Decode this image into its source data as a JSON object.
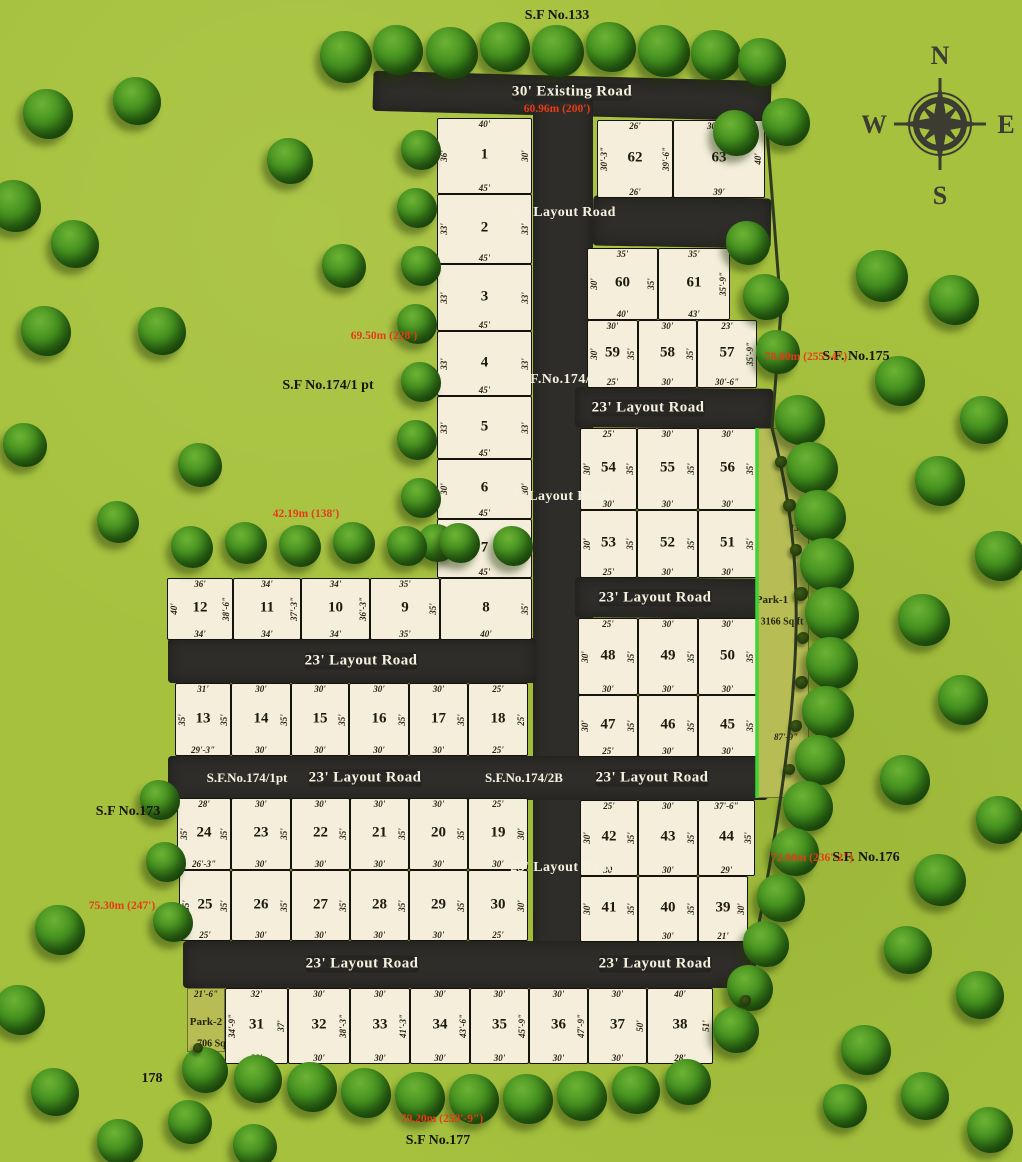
{
  "colors": {
    "background": "#a6c13e",
    "road": "#2e2d29",
    "plot_fill": "#f4eedb",
    "plot_border": "#15130e",
    "park_fill": "#b7bc55",
    "red_text": "#e63b17",
    "road_text": "#f6f1df",
    "label_text": "#15150c",
    "park_edge_green": "#3fd334",
    "boundary_line": "#2f3a22"
  },
  "compass": {
    "n": "N",
    "e": "E",
    "s": "S",
    "w": "W"
  },
  "roads": [
    {
      "name": "existing-road",
      "x": 373,
      "y": 76,
      "w": 398,
      "h": 40,
      "rot": 1.5
    },
    {
      "name": "vertical-layout-road",
      "x": 533,
      "y": 96,
      "w": 60,
      "h": 892,
      "rot": 0
    },
    {
      "name": "connector-road",
      "x": 593,
      "y": 197,
      "w": 178,
      "h": 50,
      "rot": 1
    },
    {
      "name": "layout-road-right-1",
      "x": 575,
      "y": 388,
      "w": 198,
      "h": 40,
      "rot": 0.5
    },
    {
      "name": "layout-road-right-2",
      "x": 575,
      "y": 578,
      "w": 193,
      "h": 40,
      "rot": 0.5
    },
    {
      "name": "layout-road-left-1",
      "x": 168,
      "y": 638,
      "w": 368,
      "h": 45,
      "rot": 0
    },
    {
      "name": "layout-road-middle",
      "x": 168,
      "y": 756,
      "w": 600,
      "h": 44,
      "rot": 0
    },
    {
      "name": "layout-road-bottom",
      "x": 183,
      "y": 941,
      "w": 573,
      "h": 47,
      "rot": 0
    }
  ],
  "labels": [
    {
      "text": "30' Existing Road",
      "x": 572,
      "y": 92,
      "rot": 1.5,
      "cls": "road"
    },
    {
      "text": "60.96m (200')",
      "x": 557,
      "y": 109,
      "rot": 1.5,
      "cls": "red"
    },
    {
      "text": "25' Layout Road",
      "x": 563,
      "y": 213,
      "rot": -90,
      "cls": "roadv"
    },
    {
      "text": "S.F.No.174/2A",
      "x": 563,
      "y": 380,
      "rot": -90,
      "cls": "roadv"
    },
    {
      "text": "25' Layout Road",
      "x": 558,
      "y": 497,
      "rot": -90,
      "cls": "roadv"
    },
    {
      "text": "25' Layout Road",
      "x": 563,
      "y": 868,
      "rot": -90,
      "cls": "roadv"
    },
    {
      "text": "23' Layout Road",
      "x": 648,
      "y": 408,
      "rot": 0,
      "cls": "road"
    },
    {
      "text": "23' Layout Road",
      "x": 655,
      "y": 598,
      "rot": 0,
      "cls": "road"
    },
    {
      "text": "23' Layout Road",
      "x": 361,
      "y": 661,
      "rot": 0,
      "cls": "road"
    },
    {
      "text": "S.F.No.174/1pt",
      "x": 247,
      "y": 778,
      "rot": 0,
      "cls": "roadsf"
    },
    {
      "text": "23' Layout Road",
      "x": 365,
      "y": 778,
      "rot": 0,
      "cls": "road"
    },
    {
      "text": "S.F.No.174/2B",
      "x": 524,
      "y": 778,
      "rot": 0,
      "cls": "roadsf"
    },
    {
      "text": "23' Layout Road",
      "x": 652,
      "y": 778,
      "rot": 0,
      "cls": "road"
    },
    {
      "text": "23' Layout Road",
      "x": 362,
      "y": 964,
      "rot": 0,
      "cls": "road"
    },
    {
      "text": "23' Layout Road",
      "x": 655,
      "y": 964,
      "rot": 0,
      "cls": "road"
    },
    {
      "text": "S.F No.133",
      "x": 557,
      "y": 16,
      "rot": 0,
      "cls": "sf"
    },
    {
      "text": "S.F No.174/1 pt",
      "x": 328,
      "y": 386,
      "rot": 0,
      "cls": "sf"
    },
    {
      "text": "S.F. No.175",
      "x": 856,
      "y": 357,
      "rot": 0,
      "cls": "sf"
    },
    {
      "text": "S.F No.173",
      "x": 128,
      "y": 812,
      "rot": -68,
      "cls": "sf"
    },
    {
      "text": "S.F. No.176",
      "x": 866,
      "y": 858,
      "rot": 0,
      "cls": "sf"
    },
    {
      "text": "S.F No.177",
      "x": 438,
      "y": 1141,
      "rot": 0,
      "cls": "sf"
    },
    {
      "text": "178",
      "x": 152,
      "y": 1079,
      "rot": 0,
      "cls": "sf"
    },
    {
      "text": "69.50m (228')",
      "x": 384,
      "y": 336,
      "rot": -90,
      "cls": "red"
    },
    {
      "text": "42.19m (138')",
      "x": 306,
      "y": 514,
      "rot": 0,
      "cls": "red"
    },
    {
      "text": "75.30m (247')",
      "x": 122,
      "y": 906,
      "rot": -72,
      "cls": "red"
    },
    {
      "text": "78.00m (255'-4\")",
      "x": 806,
      "y": 357,
      "rot": 62,
      "cls": "red"
    },
    {
      "text": "72.00m (236'-2\")",
      "x": 812,
      "y": 858,
      "rot": 72,
      "cls": "red"
    },
    {
      "text": "79.20m (259'-9\")",
      "x": 442,
      "y": 1119,
      "rot": 0,
      "cls": "red"
    }
  ],
  "plots": [
    {
      "no": "1",
      "x": 437,
      "y": 118,
      "w": 95,
      "h": 76,
      "t": "40'",
      "l": "36'",
      "r": "30'",
      "b": "45'"
    },
    {
      "no": "2",
      "x": 437,
      "y": 194,
      "w": 95,
      "h": 70,
      "l": "33'",
      "r": "33'",
      "b": "45'"
    },
    {
      "no": "3",
      "x": 437,
      "y": 264,
      "w": 95,
      "h": 67,
      "l": "33'",
      "r": "33'",
      "b": "45'"
    },
    {
      "no": "4",
      "x": 437,
      "y": 331,
      "w": 95,
      "h": 65,
      "l": "33'",
      "r": "33'",
      "b": "45'"
    },
    {
      "no": "5",
      "x": 437,
      "y": 396,
      "w": 95,
      "h": 63,
      "l": "33'",
      "r": "33'",
      "b": "45'"
    },
    {
      "no": "6",
      "x": 437,
      "y": 459,
      "w": 95,
      "h": 60,
      "l": "30'",
      "r": "30'",
      "b": "45'"
    },
    {
      "no": "7",
      "x": 437,
      "y": 519,
      "w": 95,
      "h": 59,
      "l": "30'",
      "r": "30'",
      "b": "45'"
    },
    {
      "no": "8",
      "x": 440,
      "y": 578,
      "w": 92,
      "h": 62,
      "r": "35'",
      "b": "40'"
    },
    {
      "no": "9",
      "x": 370,
      "y": 578,
      "w": 70,
      "h": 62,
      "t": "35'",
      "r": "35'",
      "b": "35'"
    },
    {
      "no": "10",
      "x": 301,
      "y": 578,
      "w": 69,
      "h": 62,
      "t": "34'",
      "r": "36'-3\"",
      "b": "34'"
    },
    {
      "no": "11",
      "x": 233,
      "y": 578,
      "w": 68,
      "h": 62,
      "t": "34'",
      "r": "37'-3\"",
      "b": "34'"
    },
    {
      "no": "12",
      "x": 167,
      "y": 578,
      "w": 66,
      "h": 62,
      "t": "36'",
      "l": "40'",
      "r": "38'-6\"",
      "b": "34'"
    },
    {
      "no": "13",
      "x": 175,
      "y": 683,
      "w": 56,
      "h": 73,
      "t": "31'",
      "l": "35'",
      "r": "35'",
      "b": "29'-3\""
    },
    {
      "no": "14",
      "x": 231,
      "y": 683,
      "w": 60,
      "h": 73,
      "t": "30'",
      "r": "35'",
      "b": "30'"
    },
    {
      "no": "15",
      "x": 291,
      "y": 683,
      "w": 58,
      "h": 73,
      "t": "30'",
      "r": "35'",
      "b": "30'"
    },
    {
      "no": "16",
      "x": 349,
      "y": 683,
      "w": 60,
      "h": 73,
      "t": "30'",
      "r": "35'",
      "b": "30'"
    },
    {
      "no": "17",
      "x": 409,
      "y": 683,
      "w": 59,
      "h": 73,
      "t": "30'",
      "r": "35'",
      "b": "30'"
    },
    {
      "no": "18",
      "x": 468,
      "y": 683,
      "w": 60,
      "h": 73,
      "t": "25'",
      "r": "25'",
      "b": "25'"
    },
    {
      "no": "19",
      "x": 468,
      "y": 798,
      "w": 60,
      "h": 72,
      "t": "25'",
      "r": "30'",
      "b": "30'"
    },
    {
      "no": "20",
      "x": 409,
      "y": 798,
      "w": 59,
      "h": 72,
      "t": "30'",
      "r": "35'",
      "b": "30'"
    },
    {
      "no": "21",
      "x": 350,
      "y": 798,
      "w": 59,
      "h": 72,
      "t": "30'",
      "r": "35'",
      "b": "30'"
    },
    {
      "no": "22",
      "x": 291,
      "y": 798,
      "w": 59,
      "h": 72,
      "t": "30'",
      "r": "35'",
      "b": "30'"
    },
    {
      "no": "23",
      "x": 231,
      "y": 798,
      "w": 60,
      "h": 72,
      "t": "30'",
      "r": "35'",
      "b": "30'"
    },
    {
      "no": "24",
      "x": 177,
      "y": 798,
      "w": 54,
      "h": 72,
      "t": "28'",
      "l": "35'",
      "r": "35'",
      "b": "26'-3\""
    },
    {
      "no": "25",
      "x": 179,
      "y": 870,
      "w": 52,
      "h": 71,
      "l": "35'",
      "r": "35'",
      "b": "25'"
    },
    {
      "no": "26",
      "x": 231,
      "y": 870,
      "w": 60,
      "h": 71,
      "r": "35'",
      "b": "30'"
    },
    {
      "no": "27",
      "x": 291,
      "y": 870,
      "w": 59,
      "h": 71,
      "r": "35'",
      "b": "30'"
    },
    {
      "no": "28",
      "x": 350,
      "y": 870,
      "w": 59,
      "h": 71,
      "r": "35'",
      "b": "30'"
    },
    {
      "no": "29",
      "x": 409,
      "y": 870,
      "w": 59,
      "h": 71,
      "r": "35'",
      "b": "30'"
    },
    {
      "no": "30",
      "x": 468,
      "y": 870,
      "w": 60,
      "h": 71,
      "r": "30'",
      "b": "25'"
    },
    {
      "no": "31",
      "x": 225,
      "y": 988,
      "w": 63,
      "h": 76,
      "t": "32'",
      "l": "34'-9\"",
      "r": "37'",
      "b": "32'"
    },
    {
      "no": "32",
      "x": 288,
      "y": 988,
      "w": 62,
      "h": 76,
      "t": "30'",
      "r": "38'-3\"",
      "b": "30'"
    },
    {
      "no": "33",
      "x": 350,
      "y": 988,
      "w": 60,
      "h": 76,
      "t": "30'",
      "r": "41'-3\"",
      "b": "30'"
    },
    {
      "no": "34",
      "x": 410,
      "y": 988,
      "w": 60,
      "h": 76,
      "t": "30'",
      "r": "43'-6\"",
      "b": "30'"
    },
    {
      "no": "35",
      "x": 470,
      "y": 988,
      "w": 59,
      "h": 76,
      "t": "30'",
      "r": "45'-9\"",
      "b": "30'"
    },
    {
      "no": "36",
      "x": 529,
      "y": 988,
      "w": 59,
      "h": 76,
      "t": "30'",
      "r": "47'-9\"",
      "b": "30'"
    },
    {
      "no": "37",
      "x": 588,
      "y": 988,
      "w": 59,
      "h": 76,
      "t": "30'",
      "r": "50'",
      "b": "30'"
    },
    {
      "no": "38",
      "x": 647,
      "y": 988,
      "w": 66,
      "h": 76,
      "t": "40'",
      "r": "51'",
      "b": "28'"
    },
    {
      "no": "39",
      "x": 698,
      "y": 876,
      "w": 50,
      "h": 66,
      "r": "30'",
      "b": "21'"
    },
    {
      "no": "40",
      "x": 638,
      "y": 876,
      "w": 60,
      "h": 66,
      "r": "35'",
      "b": "30'"
    },
    {
      "no": "41",
      "x": 580,
      "y": 876,
      "w": 58,
      "h": 66,
      "l": "30'",
      "r": "35'"
    },
    {
      "no": "42",
      "x": 580,
      "y": 800,
      "w": 58,
      "h": 76,
      "t": "25'",
      "l": "30'",
      "r": "35'",
      "b": "30'"
    },
    {
      "no": "43",
      "x": 638,
      "y": 800,
      "w": 60,
      "h": 76,
      "t": "30'",
      "r": "35'",
      "b": "30'"
    },
    {
      "no": "44",
      "x": 698,
      "y": 800,
      "w": 57,
      "h": 76,
      "t": "37'-6\"",
      "r": "35'",
      "b": "29'"
    },
    {
      "no": "45",
      "x": 698,
      "y": 695,
      "w": 59,
      "h": 62,
      "r": "35'",
      "b": "30'"
    },
    {
      "no": "46",
      "x": 638,
      "y": 695,
      "w": 60,
      "h": 62,
      "r": "35'",
      "b": "30'"
    },
    {
      "no": "47",
      "x": 578,
      "y": 695,
      "w": 60,
      "h": 62,
      "l": "30'",
      "r": "35'",
      "b": "25'"
    },
    {
      "no": "48",
      "x": 578,
      "y": 618,
      "w": 60,
      "h": 77,
      "t": "25'",
      "l": "30'",
      "r": "35'",
      "b": "30'"
    },
    {
      "no": "49",
      "x": 638,
      "y": 618,
      "w": 60,
      "h": 77,
      "t": "30'",
      "r": "35'",
      "b": "30'"
    },
    {
      "no": "50",
      "x": 698,
      "y": 618,
      "w": 59,
      "h": 77,
      "t": "30'",
      "r": "35'",
      "b": "30'"
    },
    {
      "no": "51",
      "x": 698,
      "y": 510,
      "w": 59,
      "h": 68,
      "r": "35'",
      "b": "30'"
    },
    {
      "no": "52",
      "x": 637,
      "y": 510,
      "w": 61,
      "h": 68,
      "r": "35'",
      "b": "30'"
    },
    {
      "no": "53",
      "x": 580,
      "y": 510,
      "w": 57,
      "h": 68,
      "l": "30'",
      "r": "35'",
      "b": "25'"
    },
    {
      "no": "54",
      "x": 580,
      "y": 428,
      "w": 57,
      "h": 82,
      "t": "25'",
      "l": "30'",
      "r": "35'",
      "b": "30'"
    },
    {
      "no": "55",
      "x": 637,
      "y": 428,
      "w": 61,
      "h": 82,
      "t": "30'",
      "r": "35'",
      "b": "30'"
    },
    {
      "no": "56",
      "x": 698,
      "y": 428,
      "w": 59,
      "h": 82,
      "t": "30'",
      "r": "35'",
      "b": "30'"
    },
    {
      "no": "57",
      "x": 697,
      "y": 320,
      "w": 60,
      "h": 68,
      "t": "23'",
      "r": "35'-9\"",
      "b": "30'-6\""
    },
    {
      "no": "58",
      "x": 638,
      "y": 320,
      "w": 59,
      "h": 68,
      "t": "30'",
      "r": "35'",
      "b": "30'"
    },
    {
      "no": "59",
      "x": 587,
      "y": 320,
      "w": 51,
      "h": 68,
      "t": "30'",
      "l": "30'",
      "r": "35'",
      "b": "25'"
    },
    {
      "no": "60",
      "x": 587,
      "y": 248,
      "w": 71,
      "h": 72,
      "t": "35'",
      "l": "30'",
      "r": "35'",
      "b": "40'"
    },
    {
      "no": "61",
      "x": 658,
      "y": 248,
      "w": 72,
      "h": 72,
      "t": "35'",
      "r": "35'-9\"",
      "b": "43'"
    },
    {
      "no": "62",
      "x": 597,
      "y": 120,
      "w": 76,
      "h": 78,
      "t": "26'",
      "l": "30'-3\"",
      "r": "39'-6\"",
      "b": "26'"
    },
    {
      "no": "63",
      "x": 673,
      "y": 120,
      "w": 92,
      "h": 78,
      "t": "30'-6\"",
      "r": "40'",
      "b": "39'"
    }
  ],
  "parks": [
    {
      "name": "Park-1",
      "area": "3166 Sq.ft",
      "x": 757,
      "y": 428,
      "w": 52,
      "h": 370,
      "label_x": 772,
      "label_y": 600,
      "label_rot": -52,
      "dims": [
        {
          "text": "131'",
          "x": 798,
          "y": 528,
          "rot": -62
        },
        {
          "text": "87'-9\"",
          "x": 786,
          "y": 737,
          "rot": -70
        }
      ]
    },
    {
      "name": "Park-2",
      "area": "706 Sq.ft",
      "x": 187,
      "y": 988,
      "w": 38,
      "h": 64,
      "label_x": 206,
      "label_y": 1022,
      "label_rot": -58,
      "dims": [
        {
          "text": "21'-6\"",
          "x": 206,
          "y": 994,
          "rot": -6
        },
        {
          "text": "20'",
          "x": 204,
          "y": 1058,
          "rot": -6
        }
      ]
    }
  ],
  "trees": [
    [
      346,
      57,
      52
    ],
    [
      398,
      50,
      50
    ],
    [
      452,
      53,
      52
    ],
    [
      505,
      47,
      50
    ],
    [
      558,
      51,
      52
    ],
    [
      611,
      47,
      50
    ],
    [
      664,
      51,
      52
    ],
    [
      716,
      55,
      50
    ],
    [
      762,
      62,
      48
    ],
    [
      736,
      133,
      46
    ],
    [
      786,
      122,
      48
    ],
    [
      748,
      243,
      44
    ],
    [
      766,
      297,
      46
    ],
    [
      778,
      352,
      44
    ],
    [
      800,
      420,
      50
    ],
    [
      812,
      468,
      52
    ],
    [
      820,
      516,
      52
    ],
    [
      827,
      565,
      54
    ],
    [
      832,
      614,
      54
    ],
    [
      832,
      663,
      52
    ],
    [
      828,
      712,
      52
    ],
    [
      820,
      760,
      50
    ],
    [
      808,
      806,
      50
    ],
    [
      795,
      852,
      48
    ],
    [
      781,
      898,
      48
    ],
    [
      766,
      944,
      46
    ],
    [
      750,
      988,
      46
    ],
    [
      736,
      1030,
      46
    ],
    [
      205,
      1070,
      46
    ],
    [
      258,
      1079,
      48
    ],
    [
      312,
      1087,
      50
    ],
    [
      366,
      1093,
      50
    ],
    [
      420,
      1097,
      50
    ],
    [
      474,
      1099,
      50
    ],
    [
      528,
      1099,
      50
    ],
    [
      582,
      1096,
      50
    ],
    [
      636,
      1090,
      48
    ],
    [
      688,
      1082,
      46
    ],
    [
      421,
      150,
      40
    ],
    [
      417,
      208,
      40
    ],
    [
      421,
      266,
      40
    ],
    [
      417,
      324,
      40
    ],
    [
      421,
      382,
      40
    ],
    [
      417,
      440,
      40
    ],
    [
      421,
      498,
      40
    ],
    [
      437,
      543,
      38
    ],
    [
      192,
      547,
      42
    ],
    [
      246,
      543,
      42
    ],
    [
      300,
      546,
      42
    ],
    [
      354,
      543,
      42
    ],
    [
      407,
      546,
      40
    ],
    [
      460,
      543,
      40
    ],
    [
      513,
      546,
      40
    ],
    [
      160,
      800,
      40
    ],
    [
      166,
      862,
      40
    ],
    [
      173,
      922,
      40
    ],
    [
      48,
      114,
      50
    ],
    [
      137,
      101,
      48
    ],
    [
      15,
      206,
      52
    ],
    [
      290,
      161,
      46
    ],
    [
      75,
      244,
      48
    ],
    [
      344,
      266,
      44
    ],
    [
      162,
      331,
      48
    ],
    [
      46,
      331,
      50
    ],
    [
      25,
      445,
      44
    ],
    [
      200,
      465,
      44
    ],
    [
      118,
      522,
      42
    ],
    [
      882,
      276,
      52
    ],
    [
      954,
      300,
      50
    ],
    [
      900,
      381,
      50
    ],
    [
      984,
      420,
      48
    ],
    [
      940,
      481,
      50
    ],
    [
      1000,
      556,
      50
    ],
    [
      924,
      620,
      52
    ],
    [
      963,
      700,
      50
    ],
    [
      905,
      780,
      50
    ],
    [
      1000,
      820,
      48
    ],
    [
      940,
      880,
      52
    ],
    [
      908,
      950,
      48
    ],
    [
      980,
      995,
      48
    ],
    [
      866,
      1050,
      50
    ],
    [
      925,
      1096,
      48
    ],
    [
      990,
      1130,
      46
    ],
    [
      845,
      1106,
      44
    ],
    [
      60,
      930,
      50
    ],
    [
      20,
      1010,
      50
    ],
    [
      55,
      1092,
      48
    ],
    [
      120,
      1142,
      46
    ],
    [
      190,
      1122,
      44
    ],
    [
      255,
      1146,
      44
    ]
  ],
  "bushes": [
    [
      781,
      462,
      12
    ],
    [
      789,
      505,
      13
    ],
    [
      796,
      550,
      12
    ],
    [
      801,
      594,
      14
    ],
    [
      803,
      638,
      12
    ],
    [
      801,
      682,
      13
    ],
    [
      796,
      726,
      12
    ],
    [
      789,
      769,
      11
    ],
    [
      745,
      1000,
      11
    ],
    [
      198,
      1048,
      10
    ]
  ]
}
